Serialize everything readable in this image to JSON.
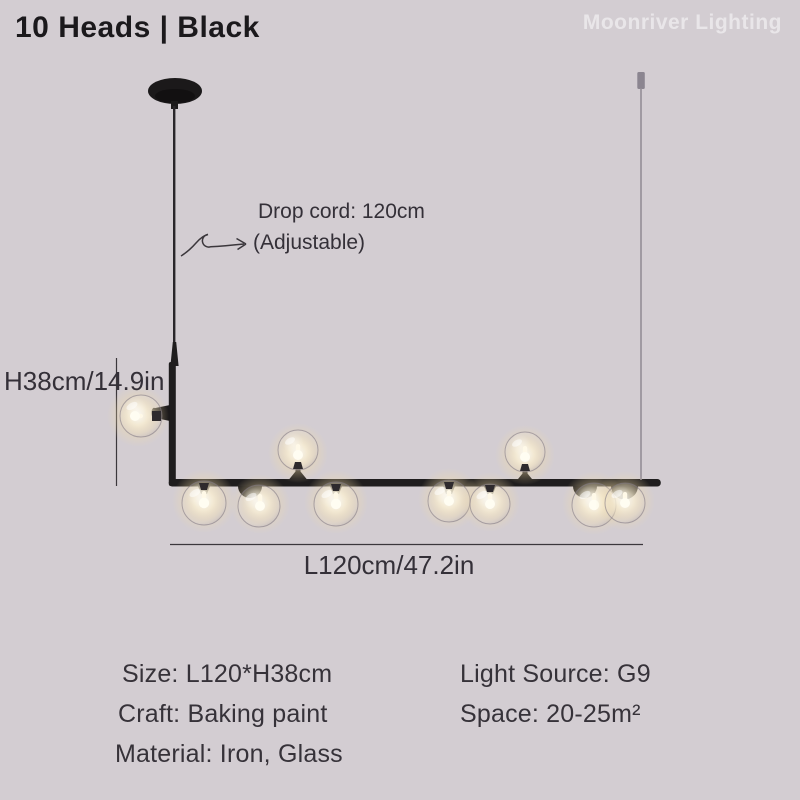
{
  "product": {
    "title": "10 Heads | Black",
    "brand_watermark": "Moonriver Lighting"
  },
  "diagram": {
    "heads_count": 10,
    "drop_cord_label": "Drop cord: 120cm",
    "drop_cord_note": "(Adjustable)",
    "height_dimension": "H38cm/14.9in",
    "length_dimension": "L120cm/47.2in"
  },
  "specs": {
    "size": "Size: L120*H38cm",
    "craft": "Craft: Baking paint",
    "material": "Material: Iron, Glass",
    "light_source": "Light Source: G9",
    "space": "Space: 20-25m²"
  },
  "colors": {
    "background": "#d3cdd2",
    "fixture_black": "#1f1d1e",
    "text_dark": "#343038",
    "glow_warm": "#f3dda6",
    "watermark": "#dedade",
    "wire_gray": "#948e96"
  }
}
